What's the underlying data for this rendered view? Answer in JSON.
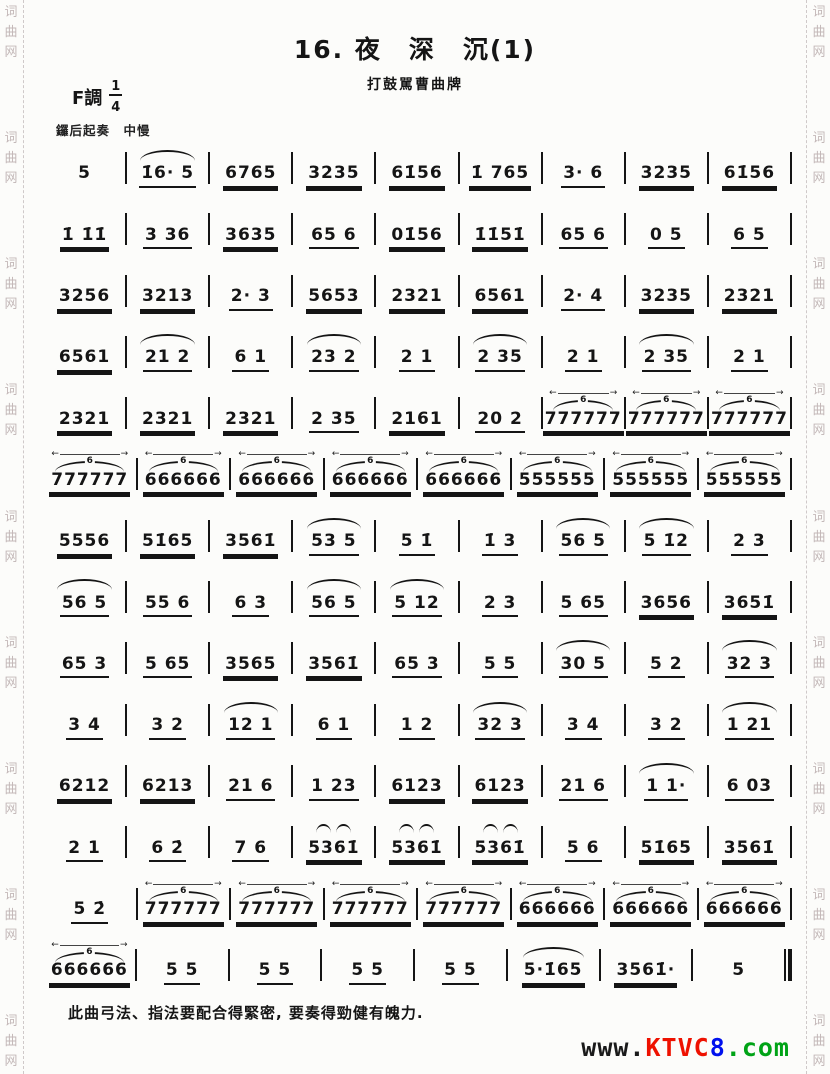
{
  "header": {
    "title": "16. 夜　深　沉(1)",
    "subtitle": "打鼓駡曹曲牌",
    "key_label": "F調",
    "meter_num": "1",
    "meter_den": "4",
    "tempo": "鑼后起奏　中慢"
  },
  "score": {
    "rows": [
      [
        {
          "n": "5",
          "u": 0
        },
        {
          "n": "1̇6· 5",
          "u": 1,
          "o": "slur"
        },
        {
          "n": "6765",
          "u": 2
        },
        {
          "n": "3235",
          "u": 2
        },
        {
          "n": "61̇56",
          "u": 2
        },
        {
          "n": "1̇ 765",
          "u": 2
        },
        {
          "n": "3· 6",
          "u": 1
        },
        {
          "n": "3235",
          "u": 2
        },
        {
          "n": "61̇56",
          "u": 2
        }
      ],
      [
        {
          "n": "1̇ 1̇1̇",
          "u": 2
        },
        {
          "n": "3 36",
          "u": 1
        },
        {
          "n": "3635",
          "u": 2
        },
        {
          "n": "65 6",
          "u": 1
        },
        {
          "n": "01̇56",
          "u": 2
        },
        {
          "n": "1̇1̇51̇",
          "u": 2
        },
        {
          "n": "65 6",
          "u": 1
        },
        {
          "n": "0 5",
          "u": 1
        },
        {
          "n": "6 5",
          "u": 1
        }
      ],
      [
        {
          "n": "3256",
          "u": 2
        },
        {
          "n": "3213",
          "u": 2
        },
        {
          "n": "2· 3",
          "u": 1
        },
        {
          "n": "5653",
          "u": 2
        },
        {
          "n": "2321",
          "u": 2
        },
        {
          "n": "6561",
          "u": 2
        },
        {
          "n": "2· 4",
          "u": 1
        },
        {
          "n": "3235",
          "u": 2
        },
        {
          "n": "2321",
          "u": 2
        }
      ],
      [
        {
          "n": "6561",
          "u": 2
        },
        {
          "n": "21 2",
          "u": 1,
          "o": "slur"
        },
        {
          "n": "6 1",
          "u": 1
        },
        {
          "n": "23 2",
          "u": 1,
          "o": "slur"
        },
        {
          "n": "2 1",
          "u": 1
        },
        {
          "n": "2 35",
          "u": 1,
          "o": "slur"
        },
        {
          "n": "2 1",
          "u": 1
        },
        {
          "n": "2 35",
          "u": 1,
          "o": "slur"
        },
        {
          "n": "2 1",
          "u": 1
        }
      ],
      [
        {
          "n": "2321",
          "u": 2
        },
        {
          "n": "2321",
          "u": 2
        },
        {
          "n": "2321",
          "u": 2
        },
        {
          "n": "2 35",
          "u": 1
        },
        {
          "n": "2161",
          "u": 2
        },
        {
          "n": "20 2",
          "u": 1
        },
        {
          "n": "777777",
          "u": 2,
          "o": "tup"
        },
        {
          "n": "777777",
          "u": 2,
          "o": "tup"
        },
        {
          "n": "777777",
          "u": 2,
          "o": "tup"
        }
      ],
      [
        {
          "n": "777777",
          "u": 2,
          "o": "tup"
        },
        {
          "n": "666666",
          "u": 2,
          "o": "tup"
        },
        {
          "n": "666666",
          "u": 2,
          "o": "tup"
        },
        {
          "n": "666666",
          "u": 2,
          "o": "tup"
        },
        {
          "n": "666666",
          "u": 2,
          "o": "tup"
        },
        {
          "n": "555555",
          "u": 2,
          "o": "tup"
        },
        {
          "n": "555555",
          "u": 2,
          "o": "tup"
        },
        {
          "n": "555555",
          "u": 2,
          "o": "tup"
        }
      ],
      [
        {
          "n": "5556",
          "u": 2
        },
        {
          "n": "51̇65",
          "u": 2
        },
        {
          "n": "3561̇",
          "u": 2
        },
        {
          "n": "53 5",
          "u": 1,
          "o": "slur"
        },
        {
          "n": "5 1̇",
          "u": 1
        },
        {
          "n": "1̇ 3",
          "u": 1
        },
        {
          "n": "56 5",
          "u": 1,
          "o": "slur"
        },
        {
          "n": "5 1̇2",
          "u": 1,
          "o": "slur"
        },
        {
          "n": "2 3",
          "u": 1
        }
      ],
      [
        {
          "n": "56 5",
          "u": 1,
          "o": "slur"
        },
        {
          "n": "55 6",
          "u": 1
        },
        {
          "n": "6 3",
          "u": 1
        },
        {
          "n": "56 5",
          "u": 1,
          "o": "slur"
        },
        {
          "n": "5 12",
          "u": 1,
          "o": "slur"
        },
        {
          "n": "2 3",
          "u": 1
        },
        {
          "n": "5 65",
          "u": 1
        },
        {
          "n": "3656",
          "u": 2
        },
        {
          "n": "3651̇",
          "u": 2
        }
      ],
      [
        {
          "n": "65 3",
          "u": 1
        },
        {
          "n": "5 65",
          "u": 1
        },
        {
          "n": "3565",
          "u": 2
        },
        {
          "n": "3561̇",
          "u": 2
        },
        {
          "n": "65 3",
          "u": 1
        },
        {
          "n": "5 5",
          "u": 1
        },
        {
          "n": "30 5",
          "u": 1,
          "o": "slur"
        },
        {
          "n": "5 2",
          "u": 1
        },
        {
          "n": "32 3",
          "u": 1,
          "o": "slur"
        }
      ],
      [
        {
          "n": "3 4",
          "u": 1
        },
        {
          "n": "3 2",
          "u": 1
        },
        {
          "n": "12 1",
          "u": 1,
          "o": "slur"
        },
        {
          "n": "6 1",
          "u": 1
        },
        {
          "n": "1 2",
          "u": 1
        },
        {
          "n": "32 3",
          "u": 1,
          "o": "slur"
        },
        {
          "n": "3 4",
          "u": 1
        },
        {
          "n": "3 2",
          "u": 1
        },
        {
          "n": "1 21",
          "u": 1,
          "o": "slur"
        }
      ],
      [
        {
          "n": "6212",
          "u": 2
        },
        {
          "n": "6213",
          "u": 2
        },
        {
          "n": "21 6",
          "u": 1
        },
        {
          "n": "1 23",
          "u": 1
        },
        {
          "n": "6123",
          "u": 2
        },
        {
          "n": "6123",
          "u": 2
        },
        {
          "n": "21 6",
          "u": 1
        },
        {
          "n": "1 1·",
          "u": 1,
          "o": "slur"
        },
        {
          "n": "6 03",
          "u": 1
        }
      ],
      [
        {
          "n": "2 1",
          "u": 1
        },
        {
          "n": "6 2̇",
          "u": 1
        },
        {
          "n": "7 6",
          "u": 1
        },
        {
          "n": "5361̇",
          "u": 2,
          "o": "arc2"
        },
        {
          "n": "5361̇",
          "u": 2,
          "o": "arc2"
        },
        {
          "n": "5361̇",
          "u": 2,
          "o": "arc2"
        },
        {
          "n": "5 6",
          "u": 1
        },
        {
          "n": "51̇65",
          "u": 2
        },
        {
          "n": "3561̇",
          "u": 2
        }
      ],
      [
        {
          "n": "5 2̇",
          "u": 1
        },
        {
          "n": "777777",
          "u": 2,
          "o": "tup"
        },
        {
          "n": "777777",
          "u": 2,
          "o": "tup"
        },
        {
          "n": "777777",
          "u": 2,
          "o": "tup"
        },
        {
          "n": "777777",
          "u": 2,
          "o": "tup"
        },
        {
          "n": "666666",
          "u": 2,
          "o": "tup"
        },
        {
          "n": "666666",
          "u": 2,
          "o": "tup"
        },
        {
          "n": "666666",
          "u": 2,
          "o": "tup"
        }
      ],
      [
        {
          "n": "666666",
          "u": 2,
          "o": "tup"
        },
        {
          "n": "5 5",
          "u": 1
        },
        {
          "n": "5 5",
          "u": 1
        },
        {
          "n": "5 5",
          "u": 1
        },
        {
          "n": "5 5",
          "u": 1
        },
        {
          "n": "5·1̇65",
          "u": 2,
          "o": "slur"
        },
        {
          "n": "3561̇·",
          "u": 2
        },
        {
          "n": "5",
          "u": 0
        }
      ]
    ],
    "tuplet_number": "6"
  },
  "footer": {
    "note": "此曲弓法、指法要配合得緊密, 要奏得勁健有魄力.",
    "watermark_parts": [
      {
        "t": "www.",
        "c": "#1a1a1a"
      },
      {
        "t": "KTVC",
        "c": "#ee1100"
      },
      {
        "t": "8",
        "c": "#0011ee"
      },
      {
        "t": ".com",
        "c": "#00a316"
      }
    ]
  },
  "side_watermark": {
    "text": "词曲网",
    "repeat": 9,
    "color": "#c3b8b8"
  }
}
